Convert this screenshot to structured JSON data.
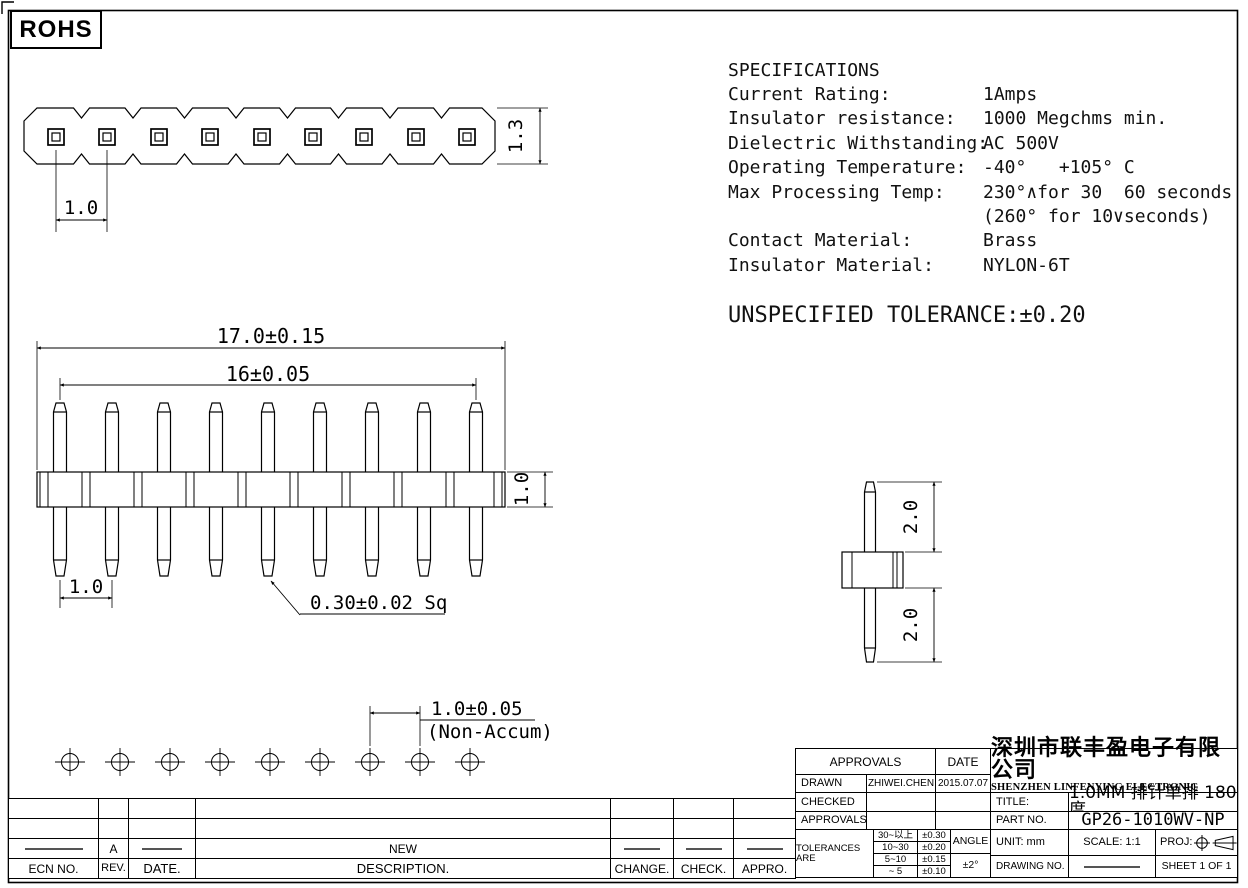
{
  "badge": {
    "rohs": "ROHS"
  },
  "specs": {
    "title": "SPECIFICATIONS",
    "rows": [
      {
        "label": "Current Rating:",
        "value": "1Amps"
      },
      {
        "label": "Insulator resistance:",
        "value": "1000 Megchms min."
      },
      {
        "label": "Dielectric Withstanding:",
        "value": "AC 500V"
      },
      {
        "label": "Operating Temperature:",
        "value": "-40°   +105° C"
      },
      {
        "label": "Max Processing Temp:",
        "value": "230°∧for 30  60 seconds"
      },
      {
        "label": "",
        "value": "(260° for 10∨seconds)"
      },
      {
        "label": "Contact Material:",
        "value": "Brass"
      },
      {
        "label": "Insulator Material:",
        "value": "NYLON-6T"
      }
    ],
    "unspecified_tolerance": "UNSPECIFIED TOLERANCE:±0.20"
  },
  "dims": {
    "top_pitch": "1.0",
    "top_height": "1.3",
    "front_overall": "17.0±0.15",
    "front_span": "16±0.05",
    "front_body": "1.0",
    "front_pitch": "1.0",
    "pin_square": "0.30±0.02 Sq",
    "side_top": "2.0",
    "side_bottom": "2.0",
    "bottom_pitch": "1.0±0.05",
    "bottom_note": "(Non-Accum)"
  },
  "title_block": {
    "approvals_header": "APPROVALS",
    "date_header": "DATE",
    "drawn_label": "DRAWN",
    "drawn_name": "ZHIWEI.CHEN",
    "drawn_date": "2015.07.07",
    "checked_label": "CHECKED",
    "approvals_label": "APPROVALS",
    "tolerances_label": "TOLERANCES ARE",
    "tolerance_rows": [
      [
        "30~以上",
        "±0.30"
      ],
      [
        "10~30",
        "±0.20"
      ],
      [
        "5~10",
        "±0.15"
      ],
      [
        "~ 5",
        "±0.10"
      ]
    ],
    "angle_label": "ANGLE",
    "angle_value": "±2°",
    "company_cn": "深圳市联丰盈电子有限公司",
    "company_en": "SHENZHEN LINFENYING ELECTRONIC CO.,LTD",
    "title_label": "TITLE:",
    "title_value": "1.0MM 排针单排 180度",
    "part_label": "PART NO.",
    "part_value": "GP26-1010WV-NP",
    "unit_label": "UNIT: mm",
    "scale_label": "SCALE: 1:1",
    "proj_label": "PROJ:",
    "drawing_no_label": "DRAWING NO.",
    "sheet_label": "SHEET 1 OF 1"
  },
  "revision_table": {
    "headers": [
      "ECN NO.",
      "REV.",
      "DATE.",
      "DESCRIPTION.",
      "CHANGE.",
      "CHECK.",
      "APPRO."
    ],
    "entry": {
      "rev": "A",
      "description": "NEW"
    }
  }
}
